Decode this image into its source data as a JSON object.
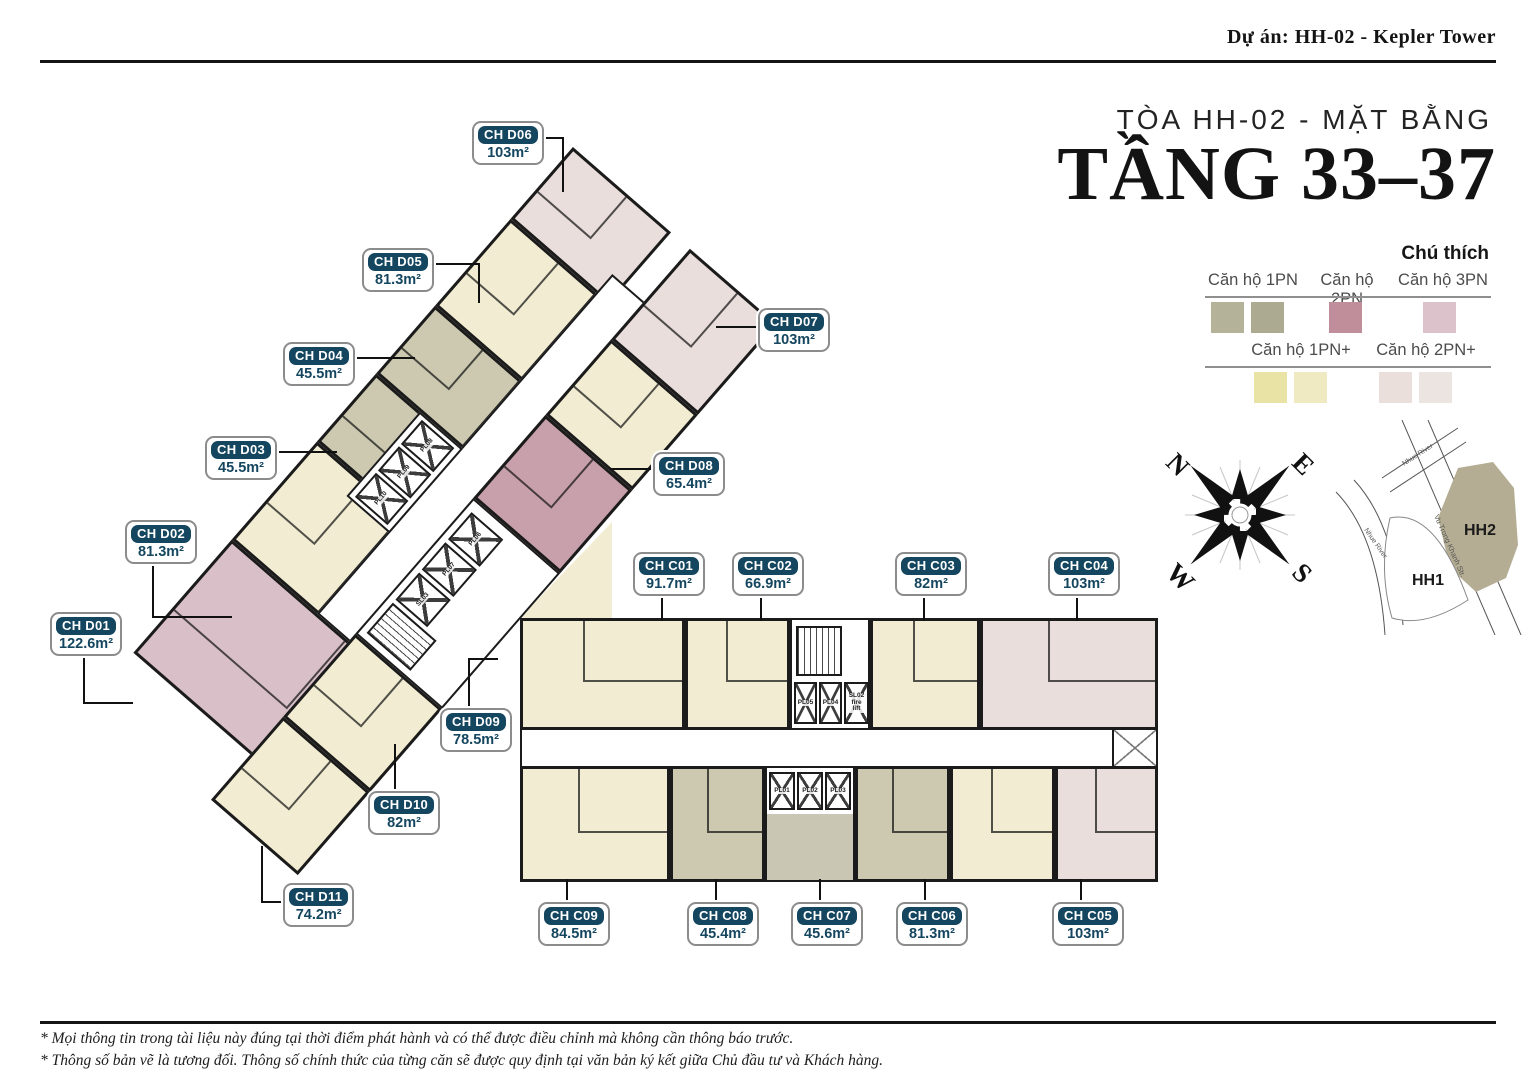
{
  "header": {
    "project": "Dự án: HH-02 - Kepler Tower",
    "subtitle": "TÒA HH-02 - MẶT BẰNG",
    "title": "TẦNG 33–37"
  },
  "legend": {
    "heading": "Chú thích",
    "row1": {
      "l1": "Căn hộ 1PN",
      "l2": "Căn hộ 2PN",
      "l3": "Căn hộ 3PN",
      "sw1": "#b4b399",
      "sw2": "#acab91",
      "sw3": "#c08e9a",
      "sw4": "#dcc2ca"
    },
    "row2": {
      "l1": "Căn hộ 1PN+",
      "l2": "Căn hộ 2PN+",
      "sw1": "#e9e4a6",
      "sw2": "#efeac1",
      "sw3": "#eadfdb",
      "sw4": "#ece4e0"
    }
  },
  "colors": {
    "pn1": "#ccc9b0",
    "pn1p": "#f2edd2",
    "pn2": "#c8a0ab",
    "pn3": "#d9bfc8",
    "pn2p": "#e9dedb",
    "lobby": "#c9c6b4",
    "wall": "#1b1b1b",
    "label_navy": "#14465f"
  },
  "apartments": [
    {
      "code": "CH D01",
      "area": "122.6m²",
      "type": "3PN"
    },
    {
      "code": "CH D02",
      "area": "81.3m²",
      "type": "1PN+"
    },
    {
      "code": "CH D03",
      "area": "45.5m²",
      "type": "1PN"
    },
    {
      "code": "CH D04",
      "area": "45.5m²",
      "type": "1PN"
    },
    {
      "code": "CH D05",
      "area": "81.3m²",
      "type": "1PN+"
    },
    {
      "code": "CH D06",
      "area": "103m²",
      "type": "2PN+"
    },
    {
      "code": "CH D07",
      "area": "103m²",
      "type": "2PN+"
    },
    {
      "code": "CH D08",
      "area": "65.4m²",
      "type": "1PN+"
    },
    {
      "code": "CH D09",
      "area": "78.5m²",
      "type": "2PN"
    },
    {
      "code": "CH D10",
      "area": "82m²",
      "type": "1PN+"
    },
    {
      "code": "CH D11",
      "area": "74.2m²",
      "type": "1PN+"
    },
    {
      "code": "CH C01",
      "area": "91.7m²",
      "type": "1PN+"
    },
    {
      "code": "CH C02",
      "area": "66.9m²",
      "type": "1PN+"
    },
    {
      "code": "CH C03",
      "area": "82m²",
      "type": "1PN+"
    },
    {
      "code": "CH C04",
      "area": "103m²",
      "type": "2PN+"
    },
    {
      "code": "CH C05",
      "area": "103m²",
      "type": "2PN+"
    },
    {
      "code": "CH C06",
      "area": "81.3m²",
      "type": "1PN+"
    },
    {
      "code": "CH C07",
      "area": "45.6m²",
      "type": "1PN"
    },
    {
      "code": "CH C08",
      "area": "45.4m²",
      "type": "1PN"
    },
    {
      "code": "CH C09",
      "area": "84.5m²",
      "type": "1PN+"
    }
  ],
  "core": {
    "d_nw": [
      "PL10",
      "PL09",
      "PL08"
    ],
    "d_se": [
      "SL03",
      "PL07",
      "PL06"
    ],
    "c_top": [
      "PL05",
      "PL04",
      "SL02\nfire lift"
    ],
    "c_bottom": [
      "PL01",
      "PL02",
      "PL03"
    ]
  },
  "compass": {
    "n": "N",
    "e": "E",
    "s": "S",
    "w": "W"
  },
  "map": {
    "hh2": "HH2",
    "hh1": "HH1",
    "street_main": "Vu Trong Khanh Str.",
    "river1": "Nhue River",
    "river2": "Nhue River",
    "hh2_color": "#b5ad93"
  },
  "footer": {
    "line1": "* Mọi thông tin trong tài liệu này đúng tại thời điểm phát hành và có thể được điều chỉnh mà không cần thông báo trước.",
    "line2": "* Thông số bản vẽ là tương đối. Thông số chính thức của từng căn sẽ được quy định tại văn bản ký kết giữa Chủ đầu tư và Khách hàng."
  }
}
